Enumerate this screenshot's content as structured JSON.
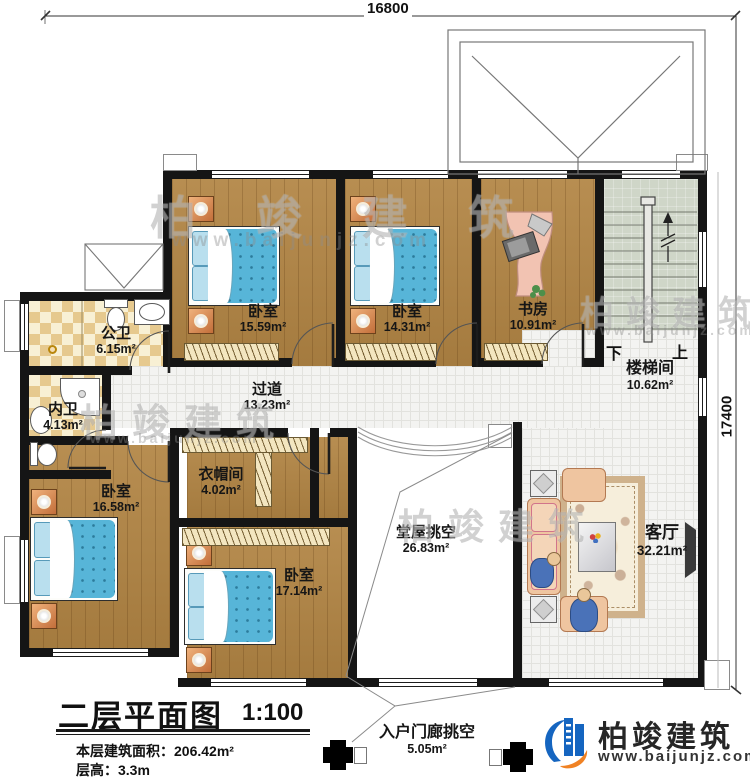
{
  "dimensions": {
    "top": "16800",
    "right": "17400"
  },
  "rooms": {
    "bedroom_top_left": {
      "name": "卧室",
      "area": "15.59m²"
    },
    "bedroom_top_mid": {
      "name": "卧室",
      "area": "14.31m²"
    },
    "study": {
      "name": "书房",
      "area": "10.91m²"
    },
    "stairwell": {
      "name": "楼梯间",
      "area": "10.62m²",
      "down": "下",
      "up": "上"
    },
    "public_bath": {
      "name": "公卫",
      "area": "6.15m²"
    },
    "private_bath": {
      "name": "内卫",
      "area": "4.13m²"
    },
    "corridor": {
      "name": "过道",
      "area": "13.23m²"
    },
    "cloakroom": {
      "name": "衣帽间",
      "area": "4.02m²"
    },
    "bedroom_left": {
      "name": "卧室",
      "area": "16.58m²"
    },
    "bedroom_bottom": {
      "name": "卧室",
      "area": "17.14m²"
    },
    "hall_void": {
      "name": "堂屋挑空",
      "area": "26.83m²"
    },
    "living_room": {
      "name": "客厅",
      "area": "32.21m²"
    },
    "porch_void": {
      "name": "入户门廊挑空",
      "area": "5.05m²"
    }
  },
  "title_block": {
    "title": "二层平面图",
    "scale": "1:100",
    "area_line": "本层建筑面积：206.42m²",
    "height_line": "层高：3.3m"
  },
  "logo": {
    "company": "柏竣建筑",
    "website": "www.baijunjz.com"
  },
  "watermark": {
    "text": "柏竣建筑",
    "url": "www.baijunjz.com"
  },
  "colors": {
    "wall": "#151515",
    "wood_floor": "#b28544",
    "bed_blue": "#57b5d8",
    "tile_tan": "#e6c98e",
    "stair_floor": "#cfd6c8",
    "nightstand_orange": "#e0935c",
    "logo_blue": "#1565c0",
    "logo_orange": "#f08224"
  }
}
